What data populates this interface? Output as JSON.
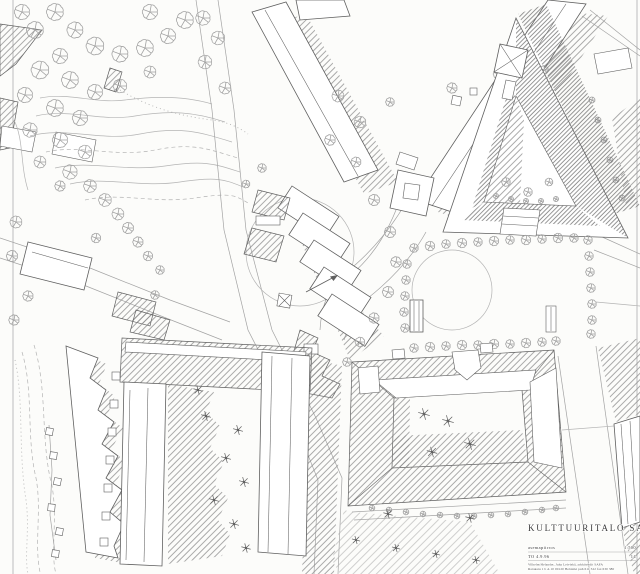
{
  "title_block": {
    "project_title": "KULTTUURITALO SANDELS",
    "drawing_title": "asemapiirros",
    "scale": "1:500",
    "date_note": "TO 4.9.96",
    "sheet_number": "14",
    "office_line_1": "Vilhelm Helander, Juha Leiviskä, arkkitehdit SAFA",
    "office_line_2": "Ratakatu 1 b A 10   00120 Helsinki   puh 611 322   fax 630 380"
  },
  "colors": {
    "paper": "#fcfcfa",
    "ink": "#606060",
    "ink_light": "#a3a3a3",
    "hatch": "#8d8d8d",
    "hatch_dark": "#7c7c7c",
    "hatch_light": "#b0b0b0",
    "contour": "#b4b4b4",
    "text": "#3d3d3d"
  }
}
